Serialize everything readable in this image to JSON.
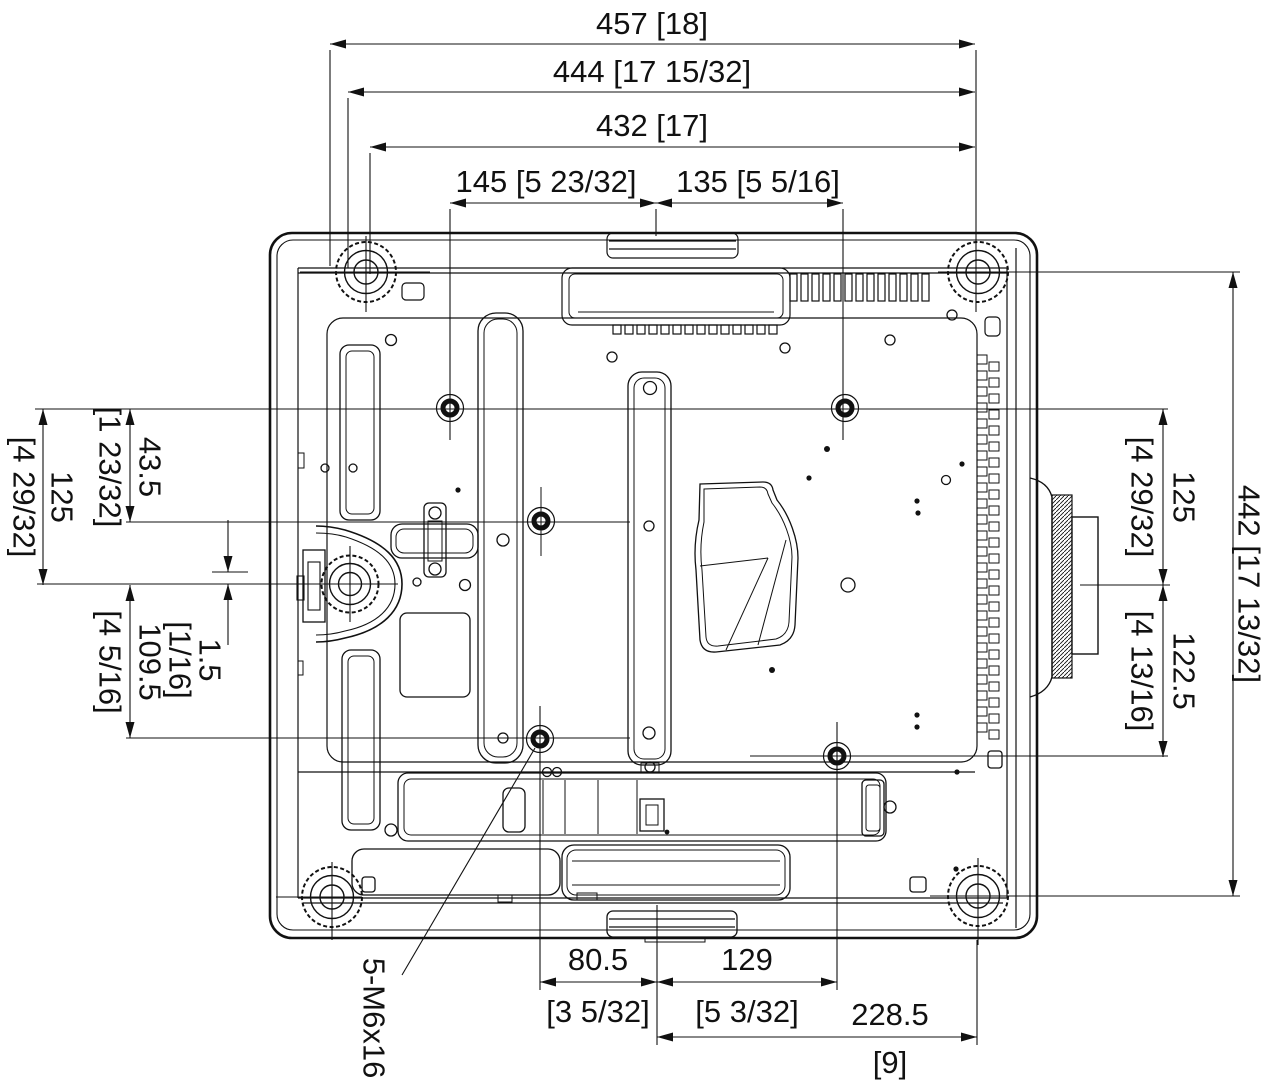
{
  "dimensions": {
    "top": [
      "457 [18]",
      "444 [17 15/32]",
      "432 [17]",
      "145 [5 23/32]",
      "135 [5 5/16]"
    ],
    "left": [
      {
        "mm": "125",
        "in": "[4 29/32]"
      },
      {
        "mm": "43.5",
        "in": "[1 23/32]"
      },
      {
        "mm": "109.5",
        "in": "[4 5/16]"
      },
      {
        "mm": "1.5",
        "in": "[1/16]"
      }
    ],
    "right": [
      {
        "mm": "125",
        "in": "[4 29/32]"
      },
      {
        "mm": "122.5",
        "in": "[4 13/16]"
      },
      {
        "mm": "442 [17 13/32]",
        "in": ""
      }
    ],
    "bottom": [
      {
        "mm": "80.5",
        "in": "[3 5/32]"
      },
      {
        "mm": "129",
        "in": "[5 3/32]"
      },
      {
        "mm": "228.5",
        "in": "[9]"
      }
    ],
    "thread_callout": "5-M6x16"
  },
  "colors": {
    "line": "#111111",
    "background": "#ffffff"
  }
}
